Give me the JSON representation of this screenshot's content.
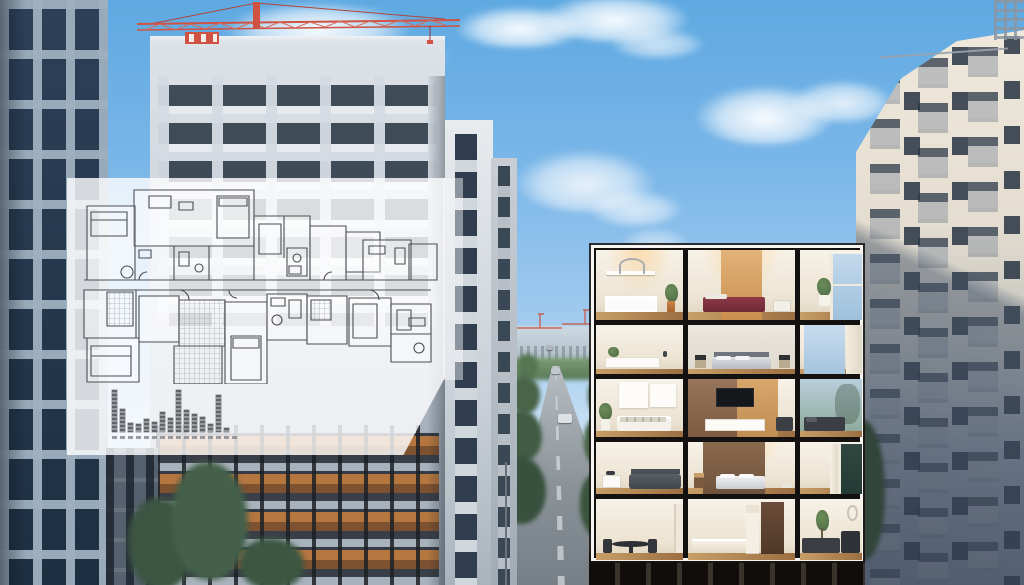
{
  "meta": {
    "title": "Architectural visualization: city residential towers with translucent floor-plan sheet and 5-storey apartment cutaway",
    "canvas": {
      "width": 1024,
      "height": 585
    },
    "visible_text": "none (only illegible micro-print under the mini bar chart)"
  },
  "palette": {
    "sky_top": "#5ea9e2",
    "sky_horizon": "#e6f0f8",
    "crane_red": "#cf5242",
    "warm_window": "#b5763f",
    "wood_light": "#c79e67",
    "wood_dark": "#9c6f42",
    "plan_line": "#4a4e55",
    "chart_bar": "#7a7c82",
    "cutaway_frame": "#141210",
    "cutaway_border": "#f6f5f2",
    "accent_tan": "#d9a263",
    "bed_maroon": "#7c2f3e",
    "tree_dark": "#3c5542"
  },
  "overlay_sheet": {
    "kind": "semi-transparent white blueprint sheet with architectural floor plan",
    "opacity": 0.82,
    "caption_legible": false
  },
  "chart_data": {
    "type": "bar",
    "title": "",
    "xlabel": "",
    "ylabel": "",
    "categories": [
      "1",
      "2",
      "3",
      "4",
      "5",
      "6",
      "7",
      "8",
      "9",
      "10",
      "11",
      "12",
      "13",
      "14",
      "15"
    ],
    "values": [
      100,
      55,
      22,
      18,
      32,
      24,
      48,
      34,
      100,
      52,
      42,
      36,
      18,
      88,
      10
    ],
    "ylim": [
      0,
      100
    ],
    "note": "miniature striped (building-like) bars printed on the blueprint sheet; labels too small to read"
  },
  "cutaway": {
    "floors": [
      {
        "rooms": [
          "home-office",
          "bedroom-red-bed",
          "window-nook-plant"
        ]
      },
      {
        "rooms": [
          "console-sideboard",
          "bedroom-grey-bed",
          "window-curtain"
        ]
      },
      {
        "rooms": [
          "living-room-white-sofa",
          "media-wall-tv",
          "lounge-chaise-window"
        ]
      },
      {
        "rooms": [
          "bedroom-dark-bed",
          "bedroom-brown-wall",
          "window-curtain"
        ]
      },
      {
        "rooms": [
          "dining-round-table",
          "kitchen-with-door",
          "living-sectional-sofa"
        ]
      }
    ]
  },
  "scene": {
    "left_tower": "dark glass grid high-rise, left edge",
    "central_tower": "white residential tower with balconies, warm-lit lower floors, red tower crane on roof",
    "secondary_towers": 2,
    "right_tower": "cream tower with stacked balconies, sunlit top and shaded base",
    "street": {
      "cars": 3,
      "lamp_posts": 1,
      "distant_cranes": 2,
      "tree_lined": true
    },
    "sky": {
      "clouds": true
    }
  }
}
